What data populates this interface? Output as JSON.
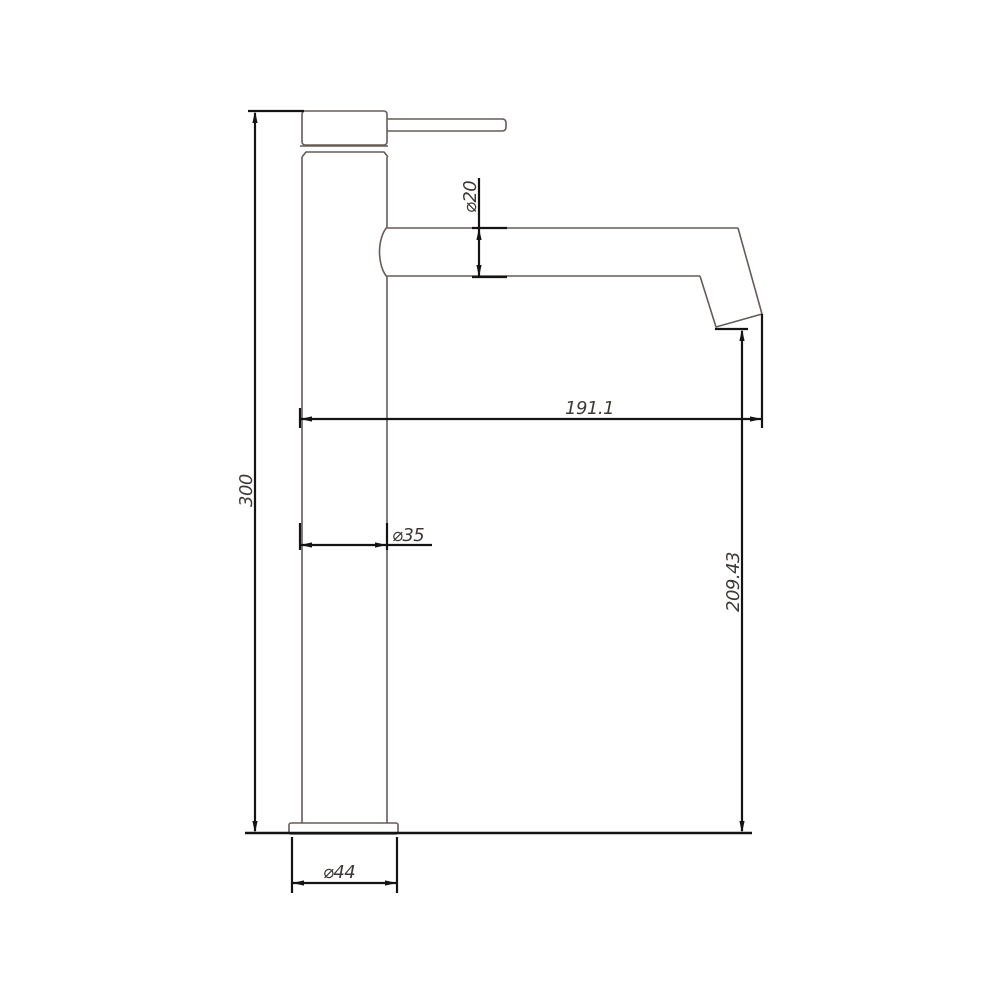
{
  "drawing": {
    "kind": "faucet-technical-drawing",
    "colors": {
      "background": "#ffffff",
      "part_line": "#665c57",
      "dimension_line": "#141414",
      "text": "#3e3933"
    },
    "dims": {
      "overall_height": {
        "label": "300"
      },
      "spout_reach": {
        "label": "191.1"
      },
      "outlet_height": {
        "label": "209.43"
      },
      "spout_diameter": {
        "label": "⌀20"
      },
      "body_diameter": {
        "label": "⌀35"
      },
      "base_diameter": {
        "label": "⌀44"
      }
    }
  }
}
